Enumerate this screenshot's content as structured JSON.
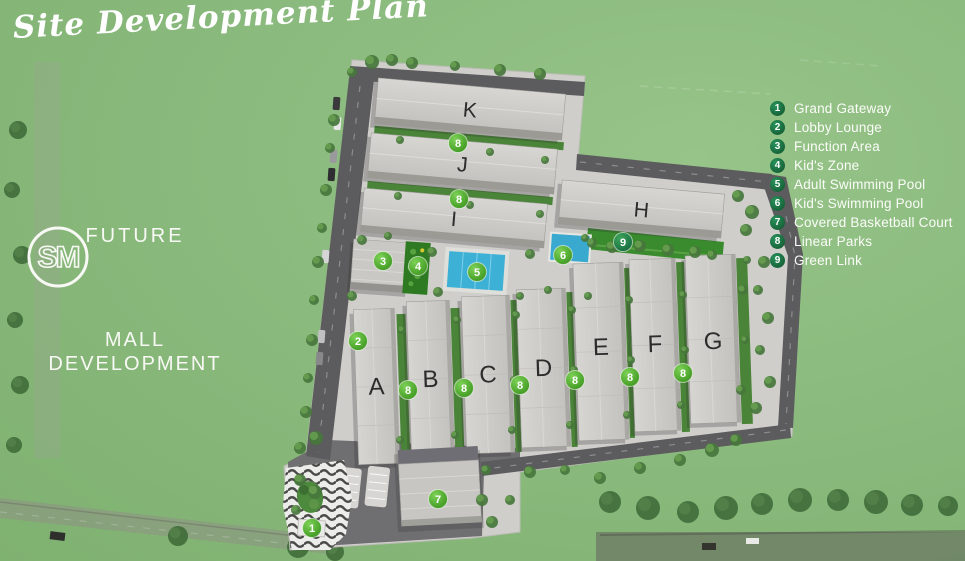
{
  "title": "Site Development Plan",
  "future_mall": {
    "line1": "FUTURE",
    "logo_text": "SM",
    "line2": "MALL",
    "line3": "DEVELOPMENT"
  },
  "legend": {
    "items": [
      {
        "num": "1",
        "label": "Grand Gateway"
      },
      {
        "num": "2",
        "label": "Lobby Lounge"
      },
      {
        "num": "3",
        "label": "Function Area"
      },
      {
        "num": "4",
        "label": "Kid's Zone"
      },
      {
        "num": "5",
        "label": "Adult Swimming Pool"
      },
      {
        "num": "6",
        "label": "Kid's Swimming Pool"
      },
      {
        "num": "7",
        "label": "Covered Basketball Court"
      },
      {
        "num": "8",
        "label": "Linear Parks"
      },
      {
        "num": "9",
        "label": "Green Link"
      }
    ]
  },
  "colors": {
    "background_green": "#8aba7d",
    "legend_badge_green": "#1d7a4b",
    "marker_bright_green": "#55ad33",
    "marker_dark_green": "#23814a",
    "pool_blue": "#3db0d6",
    "building_gray": "#cbcac6",
    "road_gray": "#5c5b5d",
    "text_white": "#ffffff"
  },
  "plan": {
    "buildings": [
      {
        "label": "K",
        "x": 376,
        "y": 86,
        "w": 188,
        "h": 46,
        "rot": 5,
        "type": "h"
      },
      {
        "label": "J",
        "x": 369,
        "y": 141,
        "w": 187,
        "h": 45,
        "rot": 5,
        "type": "h"
      },
      {
        "label": "I",
        "x": 362,
        "y": 196,
        "w": 184,
        "h": 44,
        "rot": 5,
        "type": "h"
      },
      {
        "label": "H",
        "x": 560,
        "y": 187,
        "w": 163,
        "h": 44,
        "rot": 5,
        "type": "h"
      },
      {
        "label": "A",
        "x": 356,
        "y": 309,
        "w": 41,
        "h": 155,
        "rot": -2,
        "type": "v"
      },
      {
        "label": "B",
        "x": 409,
        "y": 301,
        "w": 43,
        "h": 156,
        "rot": -2,
        "type": "v"
      },
      {
        "label": "C",
        "x": 464,
        "y": 296,
        "w": 48,
        "h": 157,
        "rot": -2,
        "type": "v"
      },
      {
        "label": "D",
        "x": 519,
        "y": 289,
        "w": 49,
        "h": 158,
        "rot": -2,
        "type": "v"
      },
      {
        "label": "E",
        "x": 576,
        "y": 263,
        "w": 50,
        "h": 177,
        "rot": -2,
        "type": "v",
        "ly": 347
      },
      {
        "label": "F",
        "x": 632,
        "y": 259,
        "w": 46,
        "h": 172,
        "rot": -2,
        "type": "v",
        "ly": 344
      },
      {
        "label": "G",
        "x": 688,
        "y": 255,
        "w": 50,
        "h": 168,
        "rot": -2,
        "type": "v",
        "ly": 341
      }
    ],
    "markers": [
      {
        "num": "1",
        "x": 312,
        "y": 528,
        "variant": "bright"
      },
      {
        "num": "2",
        "x": 358,
        "y": 341,
        "variant": "bright"
      },
      {
        "num": "3",
        "x": 383,
        "y": 261,
        "variant": "bright"
      },
      {
        "num": "4",
        "x": 418,
        "y": 266,
        "variant": "bright"
      },
      {
        "num": "5",
        "x": 477,
        "y": 272,
        "variant": "bright"
      },
      {
        "num": "6",
        "x": 563,
        "y": 255,
        "variant": "bright"
      },
      {
        "num": "7",
        "x": 438,
        "y": 499,
        "variant": "bright"
      },
      {
        "num": "8",
        "x": 458,
        "y": 143,
        "variant": "bright"
      },
      {
        "num": "8",
        "x": 459,
        "y": 199,
        "variant": "bright"
      },
      {
        "num": "8",
        "x": 408,
        "y": 390,
        "variant": "bright"
      },
      {
        "num": "8",
        "x": 464,
        "y": 388,
        "variant": "bright"
      },
      {
        "num": "8",
        "x": 520,
        "y": 385,
        "variant": "bright"
      },
      {
        "num": "8",
        "x": 575,
        "y": 380,
        "variant": "bright"
      },
      {
        "num": "8",
        "x": 630,
        "y": 377,
        "variant": "bright"
      },
      {
        "num": "8",
        "x": 683,
        "y": 373,
        "variant": "bright"
      },
      {
        "num": "9",
        "x": 623,
        "y": 242,
        "variant": "dark"
      }
    ]
  }
}
